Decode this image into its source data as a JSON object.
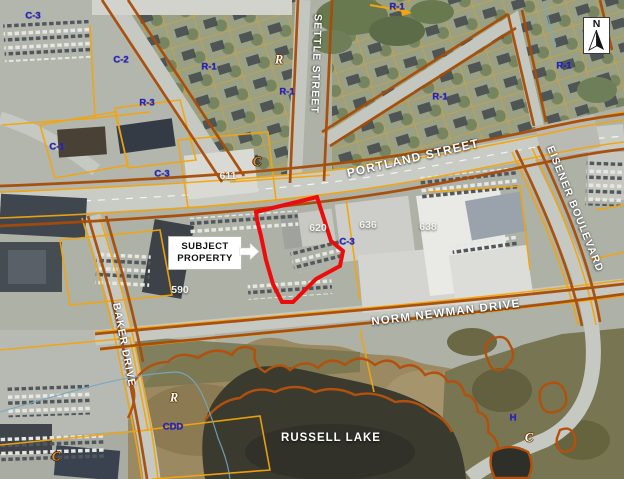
{
  "streets": {
    "portland": "PORTLAND STREET",
    "settle": "SETTLE STREET",
    "norm_newman": "NORM NEWMAN DRIVE",
    "baker": "BAKER DRIVE",
    "eisener": "EISENER BOULEVARD"
  },
  "water": {
    "russell_lake": "RUSSELL LAKE"
  },
  "civic": {
    "n611": "611",
    "n620": "620",
    "n636": "636",
    "n638": "638",
    "n590": "590"
  },
  "zones": [
    {
      "text": "C-3"
    },
    {
      "text": "C-2"
    },
    {
      "text": "R-1"
    },
    {
      "text": "R-1"
    },
    {
      "text": "R-3"
    },
    {
      "text": "C-1"
    },
    {
      "text": "R-1"
    },
    {
      "text": "R-1"
    },
    {
      "text": "R-1"
    },
    {
      "text": "C-3"
    },
    {
      "text": "C-3"
    },
    {
      "text": "CDD"
    },
    {
      "text": "H"
    },
    {
      "text": "R"
    },
    {
      "text": "R"
    },
    {
      "text": "C"
    },
    {
      "text": "C"
    },
    {
      "text": "C"
    }
  ],
  "callout": {
    "line1": "SUBJECT",
    "line2": "PROPERTY"
  },
  "north": {
    "label": "N"
  },
  "colors": {
    "subject_outline": "#ec0c0c",
    "zone_line_yellow": "#f3a50c",
    "zone_line_brown": "#a84c06",
    "greenbelt_line": "#b2500c",
    "zone_label_blue": "#2522cb",
    "road_label_white": "#ffffff"
  }
}
